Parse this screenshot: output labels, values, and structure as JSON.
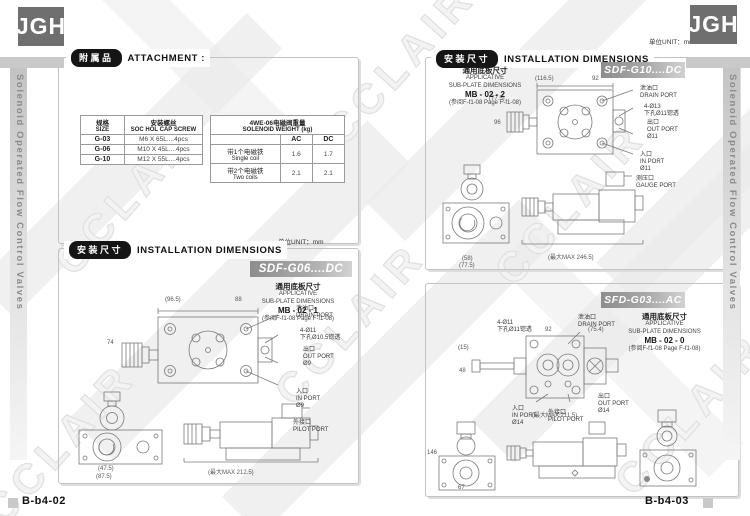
{
  "brand": {
    "logo": "JGH"
  },
  "sidebar": {
    "title": "Solenoid Operated Flow Control Valves"
  },
  "watermark": {
    "text": "CCLAIR"
  },
  "colors": {
    "pill_black": "#151515",
    "banner_gray": "#8d8d8d",
    "logo_gray": "#6f6f6f"
  },
  "left_page": {
    "page_number": "B-b4-02",
    "attachment": {
      "badge_cn": "附属品",
      "badge_en": "ATTACHMENT :",
      "screw_table": {
        "col1_cn": "规格",
        "col1_en": "SIZE",
        "col2_cn": "安装螺丝",
        "col2_en": "SOC HOL CAP SCREW",
        "rows": [
          [
            "G-03",
            "M6 X 65L....4pcs"
          ],
          [
            "G-06",
            "M10 X 45L....4pcs"
          ],
          [
            "G-10",
            "M12 X 55L....4pcs"
          ]
        ]
      },
      "weight_table": {
        "title_cn": "4WE-06电磁阀重量",
        "title_en": "SOLENOID WEIGHT  (kg)",
        "col_ac": "AC",
        "col_dc": "DC",
        "rows": [
          {
            "cn": "带1个电磁铁",
            "en": "Single coil",
            "ac": "1.6",
            "dc": "1.7"
          },
          {
            "cn": "带2个电磁铁",
            "en": "Two coils",
            "ac": "2.1",
            "dc": "2.1"
          }
        ]
      }
    },
    "install": {
      "badge_cn": "安装尺寸",
      "badge_en": "INSTALLATION DIMENSIONS",
      "unit": "单位UNIT：mm",
      "model": "SDF-G06....DC",
      "subplate": {
        "cn": "通用底板尺寸",
        "en1": "APPLICATIVE",
        "en2": "SUB-PLATE DIMENSIONS",
        "code": "MB - 02 - 1",
        "ref": "(参阅F-f1-08  Page F-f1-08)"
      },
      "ann": {
        "drain": "泄油口\nDRAIN PORT",
        "bolt": "4-Ø11\n下孔Ø10.5锪透",
        "out": "出口\nOUT PORT\nØ9",
        "in": "入口\nIN PORT\nØ9",
        "pilot": "外接口\nPILOT PORT",
        "dim_w": "(96.5)",
        "dim_w2": "88",
        "dim_h": "74",
        "dim_f1": "(47.5)",
        "dim_f2": "(87.5)",
        "dim_max": "(最大MAX 212.5)"
      }
    }
  },
  "right_page": {
    "page_number": "B-b4-03",
    "unit": "单位UNIT：mm",
    "install_badge_cn": "安装尺寸",
    "install_badge_en": "INSTALLATION DIMENSIONS",
    "g10": {
      "model": "SDF-G10....DC",
      "subplate": {
        "cn": "通用底板尺寸",
        "en1": "APPLICATIVE",
        "en2": "SUB-PLATE DIMENSIONS",
        "code": "MB - 02 - 2",
        "ref": "(参阅F-f1-08  Page F-f1-08)"
      },
      "ann": {
        "drain": "泄油口\nDRAIN PORT",
        "bolt": "4-Ø13\n下孔Ø11锪透",
        "out": "出口\nOUT PORT\nØ11",
        "in": "入口\nIN PORT\nØ11",
        "gauge": "测压口\nGAUGE PORT",
        "dim_w": "(116.5)",
        "dim_w2": "92",
        "dim_h": "(77.5)",
        "dim_h2": "96",
        "dim_f1": "(58)",
        "dim_f2": "(77.5)",
        "dim_max": "(最大MAX 246.5)"
      }
    },
    "g03": {
      "model": "SFD-G03....AC",
      "subplate": {
        "cn": "通用底板尺寸",
        "en1": "APPLICATIVE",
        "en2": "SUB-PLATE DIMENSIONS",
        "code": "MB - 02 - 0",
        "ref": "(参阅F-f1-08  Page F-f1-08)"
      },
      "ann": {
        "bolt": "4-Ø11\n下孔Ø11锪透",
        "drain": "泄油口\nDRAIN PORT",
        "in": "入口\nIN PORT\nØ14",
        "pilot": "外接口\nPILOT PORT",
        "out": "出口\nOUT PORT\nØ14",
        "dim_w": "92",
        "dim_w2": "(75.4)",
        "dim_h": "(15)",
        "dim_h2": "48",
        "dim_s1": "146",
        "dim_s2": "67",
        "dim_max": "(最大MAX 211.5)"
      }
    }
  }
}
